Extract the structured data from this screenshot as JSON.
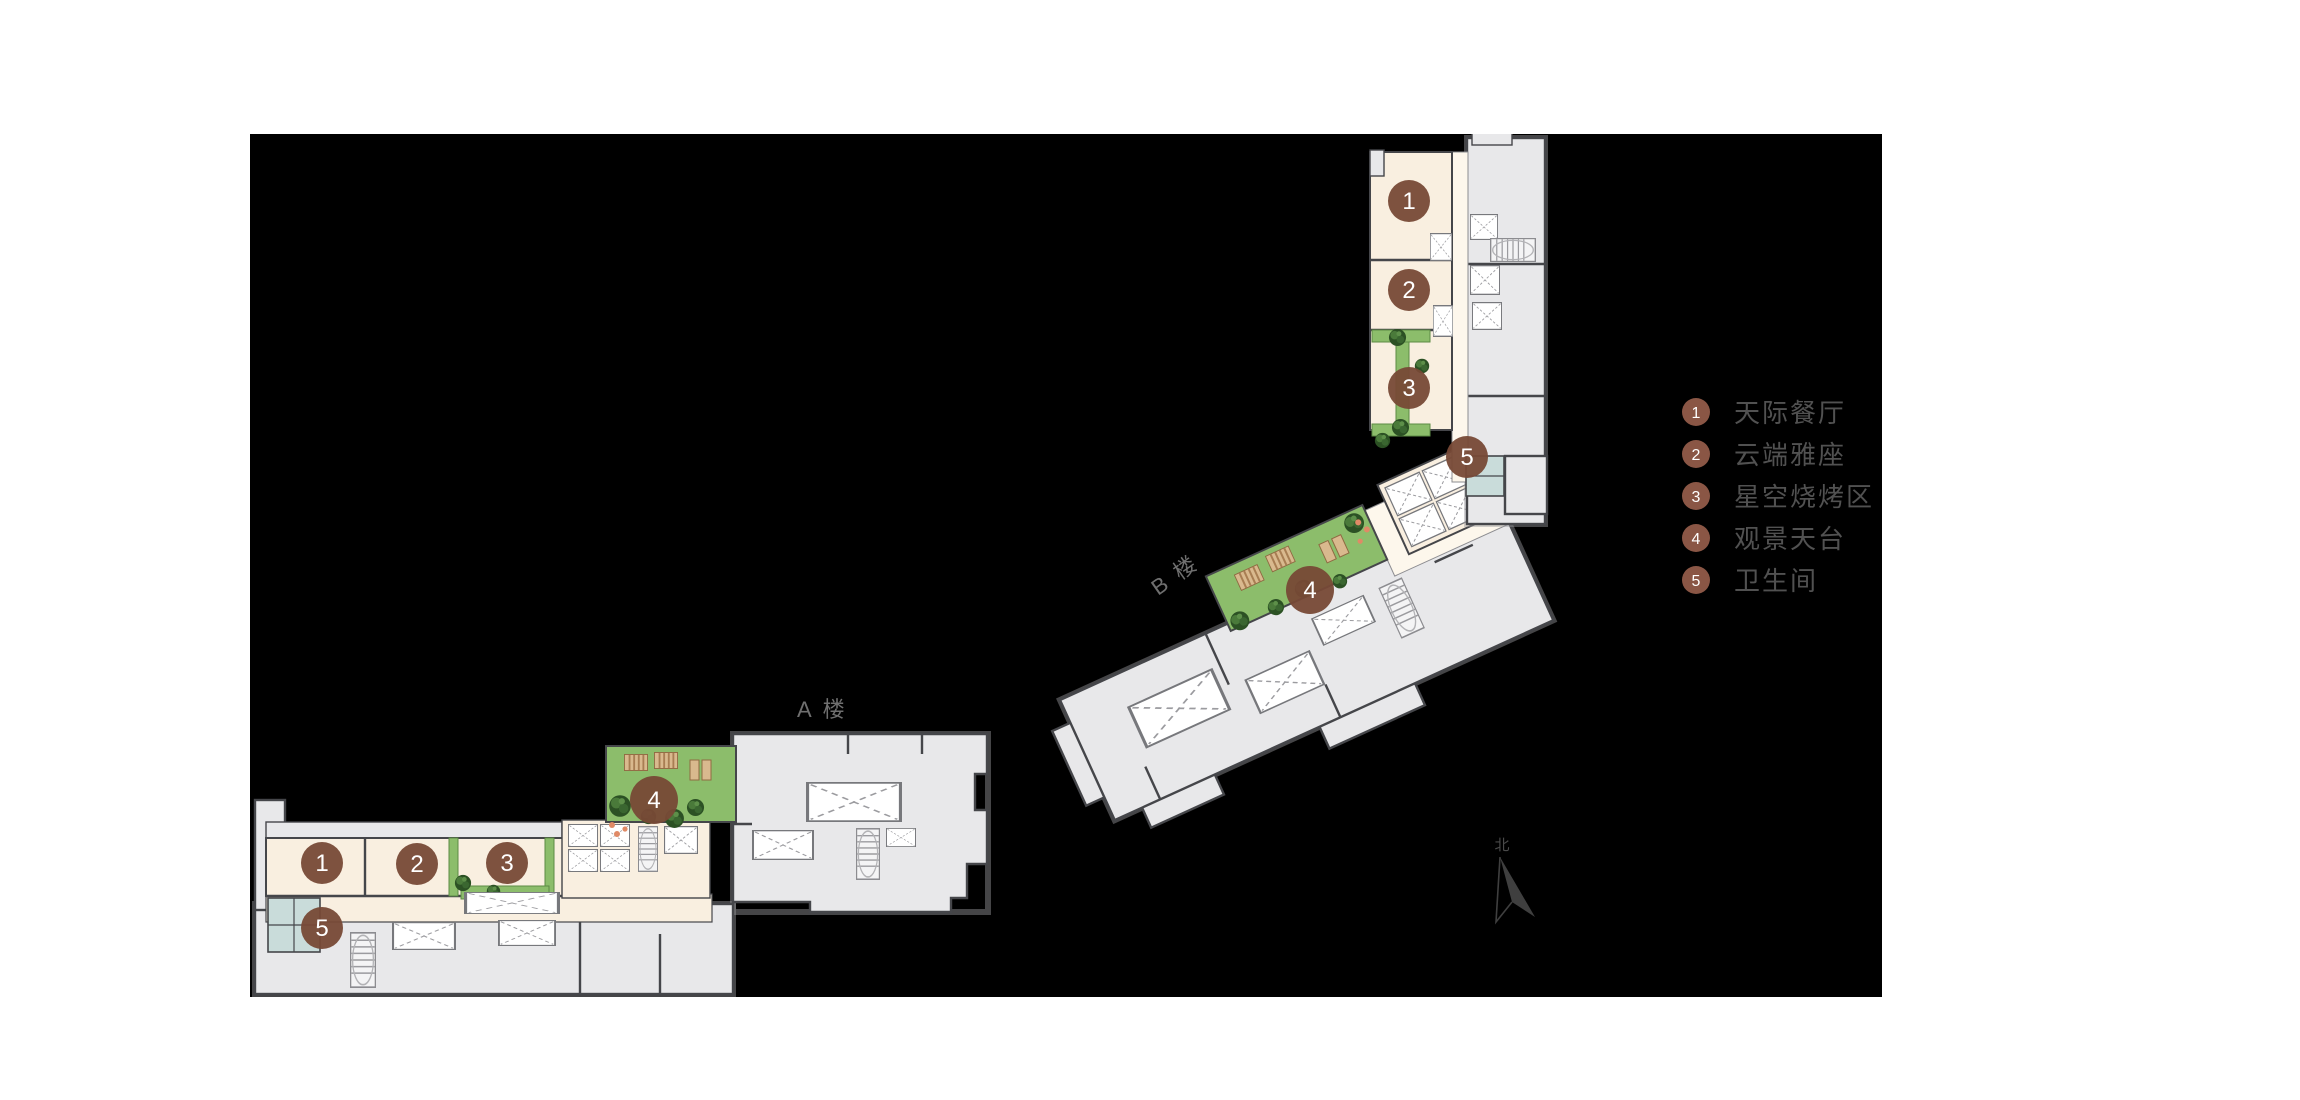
{
  "title": "屋顶楼层平面图",
  "legend": {
    "items": [
      {
        "num": "1",
        "label": "天际餐厅"
      },
      {
        "num": "2",
        "label": "云端雅座"
      },
      {
        "num": "3",
        "label": "星空烧烤区"
      },
      {
        "num": "4",
        "label": "观景天台"
      },
      {
        "num": "5",
        "label": "卫生间"
      }
    ]
  },
  "labels": {
    "building_a": "A 楼",
    "building_b": "B 楼",
    "north": "北"
  },
  "markers": {
    "m1": "1",
    "m2": "2",
    "m3": "3",
    "m4": "4",
    "m5": "5"
  },
  "colors": {
    "canvas_background": "#000000",
    "page_background": "#ffffff",
    "building_gray": "#e8e8ea",
    "wall": "#45464a",
    "room_cream": "#f9efe0",
    "corridor_cream": "#fdf7ec",
    "terrace_green": "#8cbd6b",
    "tree_green": "#2c5124",
    "restroom_teal": "#c9dcda",
    "marker_brown": "#774936",
    "legend_brown": "#8a5645",
    "legend_text": "#515151",
    "label_text": "#6f6f6f",
    "accent_dot": "#e08a66"
  }
}
